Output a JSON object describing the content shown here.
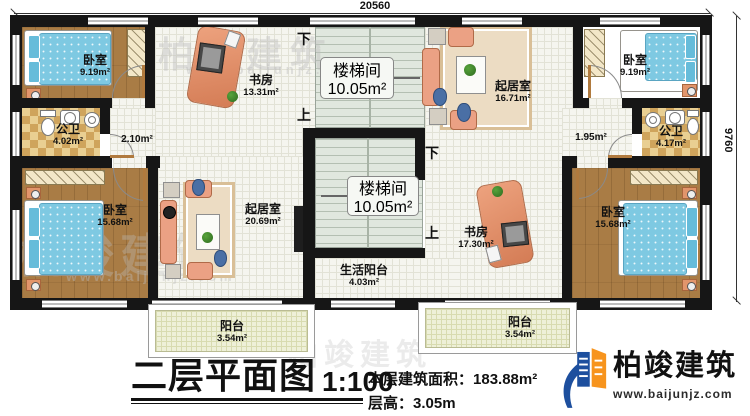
{
  "dimensions": {
    "top": "20560",
    "right": "9760"
  },
  "rooms": {
    "bedroom_tl": {
      "label": "卧室",
      "area": "9.19m²"
    },
    "bathroom_l": {
      "label": "公卫",
      "area": "4.02m²"
    },
    "corridor_l": {
      "area": "2.10m²"
    },
    "study_top": {
      "label": "书房",
      "area": "13.31m²"
    },
    "stair_top": {
      "label": "楼梯间",
      "area": "10.05m²",
      "down": "下",
      "up": "上"
    },
    "living_tr": {
      "label": "起居室",
      "area": "16.71m²"
    },
    "bedroom_tr": {
      "label": "卧室",
      "area": "9.19m²"
    },
    "corridor_r": {
      "area": "1.95m²"
    },
    "bathroom_r": {
      "label": "公卫",
      "area": "4.17m²"
    },
    "bedroom_bl": {
      "label": "卧室",
      "area": "15.68m²"
    },
    "living_bl": {
      "label": "起居室",
      "area": "20.69m²"
    },
    "stair_mid": {
      "label": "楼梯间",
      "area": "10.05m²",
      "down": "下",
      "up": "上"
    },
    "life_balcony": {
      "label": "生活阳台",
      "area": "4.03m²"
    },
    "study_bottom": {
      "label": "书房",
      "area": "17.30m²"
    },
    "bedroom_br": {
      "label": "卧室",
      "area": "15.68m²"
    },
    "balcony_left": {
      "label": "阳台",
      "area": "3.54m²"
    },
    "balcony_right": {
      "label": "阳台",
      "area": "3.54m²"
    }
  },
  "title_block": {
    "title": "二层平面图",
    "scale": "1:100",
    "area_label": "本层建筑面积：",
    "area_value": "183.88m²",
    "height_label": "层高：",
    "height_value": "3.05m"
  },
  "branding": {
    "name": "柏竣建筑",
    "website": "www.baijunjz.com"
  },
  "watermark": {
    "name": "柏竣建筑",
    "website": "www.baijunjz.com"
  },
  "colors": {
    "wall": "#161616",
    "wood": "#a97c45",
    "tile_light": "#e9cf92",
    "tile_dark": "#cfa45c",
    "floor_light": "#f5f5ef",
    "grid_line": "#e2e2d6",
    "stair_bg": "#e0e7de",
    "stair_line": "#b4bfb2",
    "balcony_floor": "#eef0d8",
    "balcony_grid": "#d8dbb0",
    "bed_blue": "#7ec9e2",
    "pillow": "#66bcda",
    "salmon": "#eba184",
    "salmon_dark": "#b06a48",
    "rug": "#ecdcc3",
    "rug_border": "#d9bf97",
    "logo_blue": "#1d4f9e",
    "logo_orange": "#f7941d",
    "watermark_gray": "#bfbfbf"
  }
}
